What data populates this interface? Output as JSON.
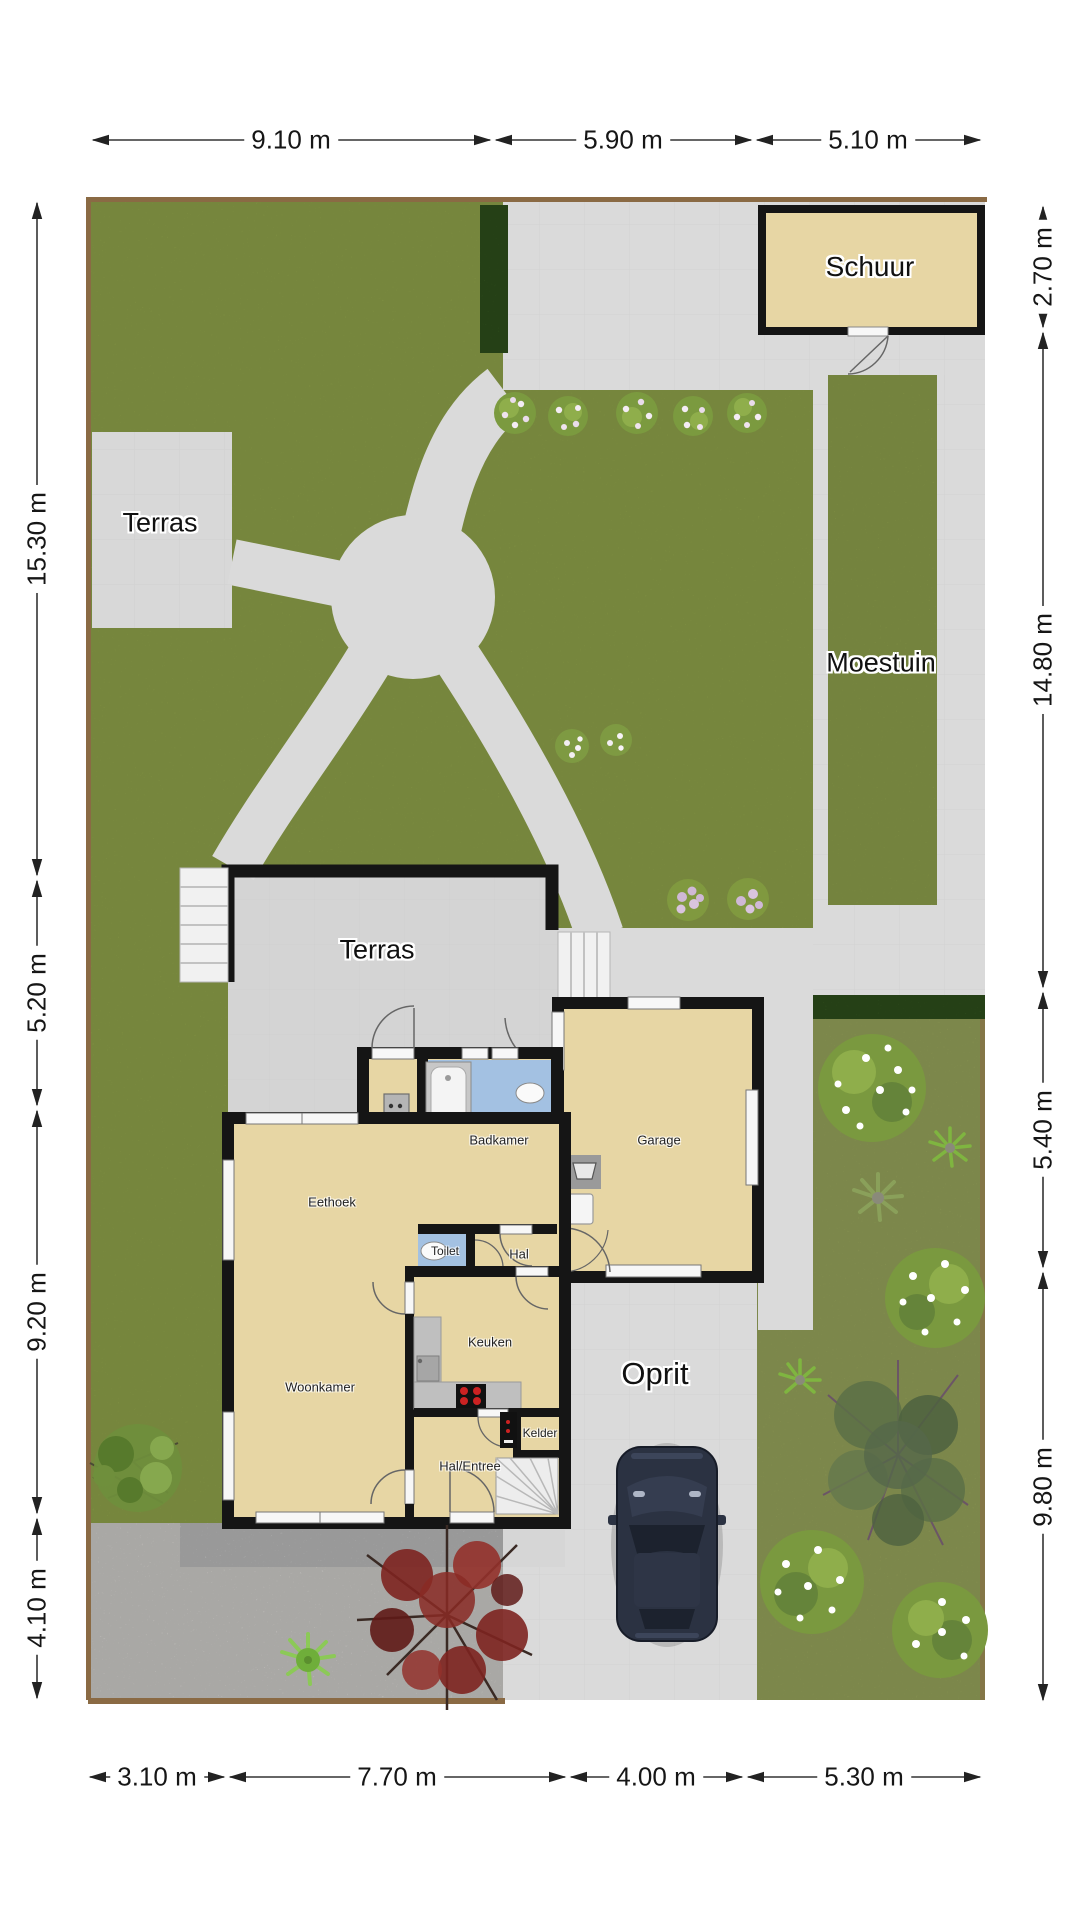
{
  "plan": {
    "areas": {
      "shed": "Schuur",
      "terrace_garden": "Terras",
      "vegetable_garden": "Moestuin",
      "terrace_house": "Terras",
      "driveway": "Oprit"
    },
    "rooms": {
      "bathroom": "Badkamer",
      "dining_nook": "Eethoek",
      "toilet": "Toilet",
      "hall": "Hal",
      "garage": "Garage",
      "kitchen": "Keuken",
      "living_room": "Woonkamer",
      "cellar": "Kelder",
      "entrance_hall": "Hal/Entree"
    },
    "dimensions": {
      "top": [
        "9.10 m",
        "5.90 m",
        "5.10 m"
      ],
      "right": [
        "2.70 m",
        "14.80 m",
        "5.40 m",
        "9.80 m"
      ],
      "bottom": [
        "3.10 m",
        "7.70 m",
        "4.00 m",
        "5.30 m"
      ],
      "left": [
        "15.30 m",
        "5.20 m",
        "9.20 m",
        "4.10 m"
      ]
    },
    "palette": {
      "grass": "#8ea149",
      "grass_side": "#99a65c",
      "paving": "#dadada",
      "gravel": "#eceae6",
      "room_fill": "#e7d6a4",
      "wet_room_fill": "#a3c1e2",
      "wall": "#151515",
      "hedge": "#3a6323",
      "fence": "#8a6a44",
      "counter": "#bfbfbf",
      "car_body": "#2b3242",
      "red_tree": "#7d2420"
    }
  }
}
